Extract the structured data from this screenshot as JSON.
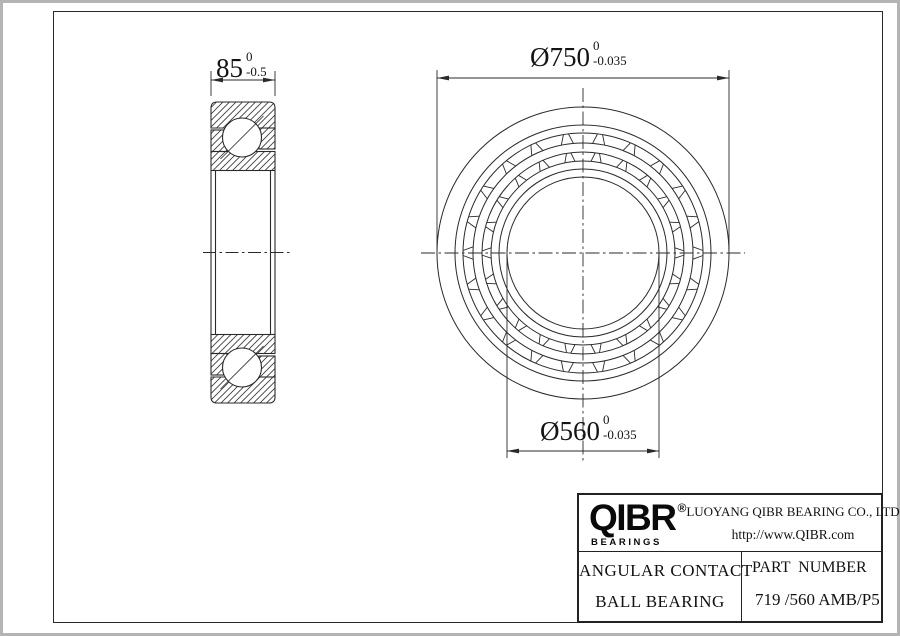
{
  "dims": [
    {
      "label": "85",
      "tol_top": "0",
      "tol_bottom": "-0.5",
      "y": 80,
      "xa": 211,
      "xb": 275,
      "ext_top": 71,
      "ext_bot": 96
    },
    {
      "label": "Ø750",
      "tol_top": "0",
      "tol_bottom": "-0.035",
      "y": 78,
      "xa": 437,
      "xb": 729,
      "ext_top": 70,
      "ext_bot": 250
    },
    {
      "label": "Ø560",
      "tol_top": "0",
      "tol_bottom": "-0.035",
      "y": 451,
      "xa": 507,
      "xb": 659,
      "ext_top": 255,
      "ext_bot": 458
    }
  ],
  "drawing": {
    "stroke": "#2a2a2a",
    "section": {
      "x0": 211,
      "x1": 275,
      "top": 102,
      "bot": 403,
      "corner": 6,
      "outer_band_h": 26,
      "lobe_w": 16,
      "lobe_h": 21,
      "inner_band_h": 19,
      "inner_lobe_w": 16,
      "inner_lobe_h": 21.5,
      "inner_band_y_top": 151.5,
      "inner_band_y_bot": 334.5,
      "inner_lobe_y_top": 130,
      "inner_lobe_y_bot": 353.5,
      "cage": {
        "x": 227.5,
        "w": 5.5,
        "h": 20.5,
        "y_top": 131,
        "y_bot": 353.5
      },
      "ball": {
        "cx": 242,
        "r": 19.5,
        "cy_top": 137.5,
        "cy_bot": 367.5,
        "diag": 21.5
      },
      "bore_inset": 4.5,
      "bore_y0": 170.5,
      "bore_y1": 334.5,
      "centerline": {
        "y": 252.5,
        "x0": 203,
        "x1": 291
      }
    },
    "front": {
      "cx": 583,
      "cy": 253,
      "radii": [
        146,
        128,
        120,
        110,
        101,
        92,
        84,
        76
      ],
      "bands": [
        {
          "ri": 110,
          "ro": 120,
          "n": 22
        },
        {
          "ri": 92,
          "ro": 101,
          "n": 22
        }
      ],
      "centerline_h": {
        "x0": 421,
        "x1": 745
      },
      "centerline_v": {
        "y0": 88,
        "y1": 462
      }
    }
  },
  "title_block": {
    "logo": "QIBR",
    "reg": "®",
    "logo_subtitle": "BEARINGS",
    "company": "LUOYANG QIBR BEARING CO., LTD",
    "url": "http://www.QIBR.com",
    "product_line1": "ANGULAR CONTACT",
    "product_line2": "BALL BEARING",
    "part_label": "PART  NUMBER",
    "part_number": "719 /560 AMB/P5"
  }
}
